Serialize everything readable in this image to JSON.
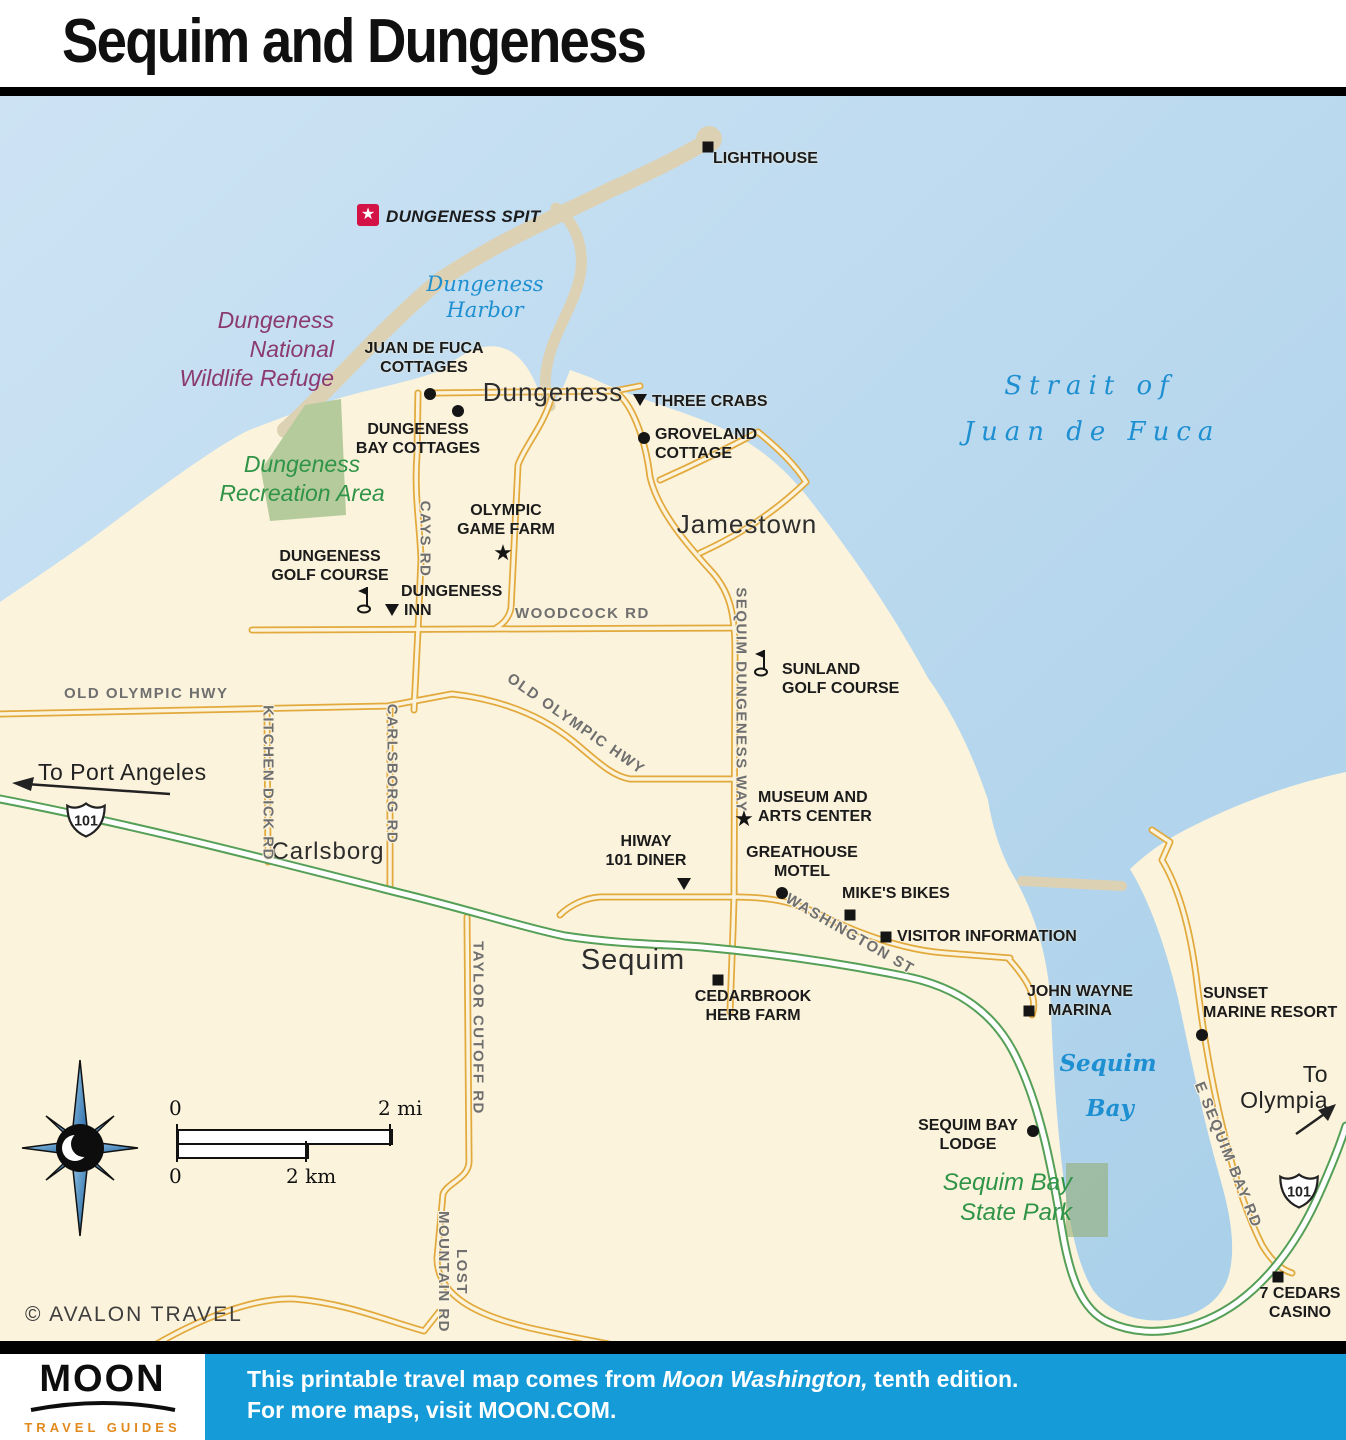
{
  "title": "Sequim and Dungeness",
  "icons": {
    "star": "★"
  },
  "water": {
    "harbor_l1": "Dungeness",
    "harbor_l2": "Harbor",
    "strait_l1": "Strait of",
    "strait_l2": "Juan de Fuca",
    "bay_l1": "Sequim",
    "bay_l2": "Bay"
  },
  "areas": {
    "refuge_l1": "Dungeness",
    "refuge_l2": "National",
    "refuge_l3": "Wildlife Refuge",
    "recreation_l1": "Dungeness",
    "recreation_l2": "Recreation Area",
    "state_park_l1": "Sequim Bay",
    "state_park_l2": "State Park"
  },
  "towns": {
    "dungeness": "Dungeness",
    "jamestown": "Jamestown",
    "carlsborg": "Carlsborg",
    "sequim": "Sequim"
  },
  "roads": {
    "cays": "CAYS RD",
    "woodcock": "WOODCOCK RD",
    "sequim_dungeness": "SEQUIM DUNGENESS WAY",
    "old_olympic_w": "OLD OLYMPIC HWY",
    "old_olympic_c": "OLD OLYMPIC HWY",
    "kitchen_dick": "KITCHEN DICK RD",
    "carlsborg_rd": "CARLSBORG RD",
    "washington": "WASHINGTON ST",
    "taylor_cutoff": "TAYLOR CUTOFF RD",
    "lost_mountain_l1": "LOST",
    "lost_mountain_l2": "MOUNTAIN RD",
    "e_sequim_bay": "E SEQUIM BAY RD"
  },
  "highways": {
    "us101": "101"
  },
  "pois": {
    "lighthouse": {
      "l1": "LIGHTHOUSE"
    },
    "dungeness_spit": {
      "l1": "DUNGENESS SPIT"
    },
    "juan_de_fuca_cottages": {
      "l1": "JUAN DE FUCA",
      "l2": "COTTAGES"
    },
    "dungeness_bay_cottages": {
      "l1": "DUNGENESS",
      "l2": "BAY COTTAGES"
    },
    "three_crabs": {
      "l1": "THREE CRABS"
    },
    "groveland_cottage": {
      "l1": "GROVELAND",
      "l2": "COTTAGE"
    },
    "olympic_game_farm": {
      "l1": "OLYMPIC",
      "l2": "GAME FARM"
    },
    "dungeness_golf_course": {
      "l1": "DUNGENESS",
      "l2": "GOLF COURSE"
    },
    "dungeness_inn": {
      "l1": "DUNGENESS",
      "l2": "INN"
    },
    "sunland_golf_course": {
      "l1": "SUNLAND",
      "l2": "GOLF COURSE"
    },
    "museum_arts_center": {
      "l1": "MUSEUM AND",
      "l2": "ARTS CENTER"
    },
    "hiway_101_diner": {
      "l1": "HIWAY",
      "l2": "101 DINER"
    },
    "greathouse_motel": {
      "l1": "GREATHOUSE",
      "l2": "MOTEL"
    },
    "mikes_bikes": {
      "l1": "MIKE'S BIKES"
    },
    "visitor_information": {
      "l1": "VISITOR INFORMATION"
    },
    "cedarbrook_herb_farm": {
      "l1": "CEDARBROOK",
      "l2": "HERB FARM"
    },
    "john_wayne_marina": {
      "l1": "JOHN WAYNE",
      "l2": "MARINA"
    },
    "sunset_marine_resort": {
      "l1": "SUNSET",
      "l2": "MARINE RESORT"
    },
    "sequim_bay_lodge": {
      "l1": "SEQUIM BAY",
      "l2": "LODGE"
    },
    "seven_cedars_casino": {
      "l1": "7 CEDARS",
      "l2": "CASINO"
    }
  },
  "directions": {
    "port_angeles": "To Port Angeles",
    "olympia_l1": "To",
    "olympia_l2": "Olympia"
  },
  "scale": {
    "mi_start": "0",
    "mi_end": "2 mi",
    "km_start": "0",
    "km_end": "2 km"
  },
  "copyright": "© AVALON TRAVEL",
  "footer": {
    "logo_title": "MOON",
    "logo_subtitle": "TRAVEL GUIDES",
    "line1_pre": "This printable travel map comes from ",
    "line1_book": "Moon Washington,",
    "line1_post": " tenth edition.",
    "line2": "For more maps, visit MOON.COM."
  },
  "colors": {
    "water": "#b9d8ee",
    "land": "#fbf3dc",
    "spit_tan": "#ddd1b4",
    "road_yellow": "#e2a93c",
    "hwy_green": "#559f57",
    "footer_blue": "#149bd8",
    "refuge_purple": "#8a3a6e",
    "park_green": "#2f9447",
    "water_label_blue": "#1e8fd0",
    "spit_red": "#d31245"
  }
}
